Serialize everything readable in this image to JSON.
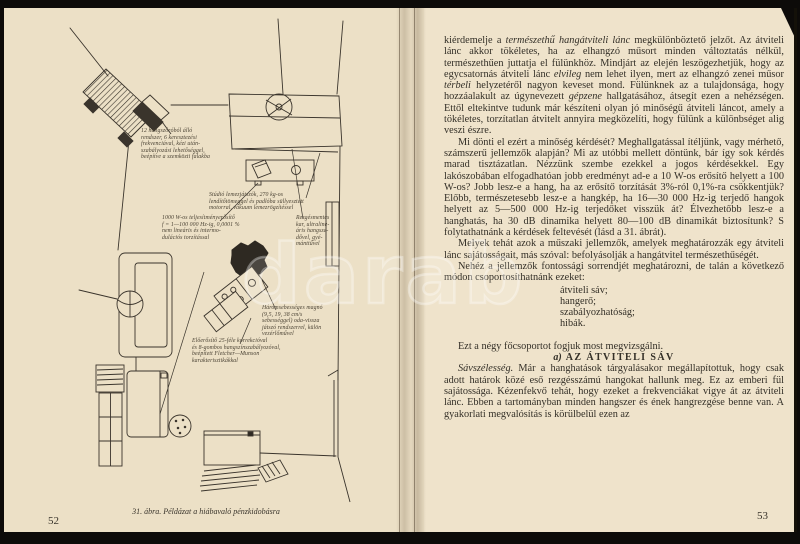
{
  "left_page": {
    "page_number": "52",
    "caption": "31. ábra. Példázat a hiábavaló pénzkidobásra",
    "labels": {
      "speaker": "12 hangszóróból álló\nrendszer, 6 keresztezési\nfrekvenciával, kézi után-\nszabályozási lehetőséggel,\nbeépítve a szemközti falakba",
      "turntable": "Stúdió lemezjátszók, 270 kg-os\nlendítőtömeggel és padlóba süllyesztett\nmotorral, vákuum lemezrögzítéssel",
      "amplifier": "1000 W-os teljesítményerősítő\nf = 1—100 000 Hz-ig, 0,0001 %\nnem lineáris és intermo-\ndulációs torzítással",
      "tonearm": "Rezgésmentes\nkar, ultraline-\náris hangsze-\ndővel, gyé-\nmánttűvel",
      "tape": "Háromsebességes magnó\n(9,5, 19, 38 cm/s\nsebességgel) oda-vissza\njátszó rendszerrel, külön\nvezérlőművel",
      "preamp": "Előerősítő 25-féle korrekcióval\nés 8-gombos hangszínszabályozóval,\nbeépített Fletcher—Munson\nkarakterisztikákkal"
    }
  },
  "right_page": {
    "page_number": "53",
    "paragraphs": {
      "p1": [
        {
          "t": "kiérdemelje a "
        },
        {
          "t": "természethű hangátviteli lánc",
          "i": true
        },
        {
          "t": " megkülönböztető jelzőt. Az átviteli lánc akkor tökéletes, ha az elhangzó műsort minden változtatás nélkül, természethűen juttatja el fülünkhöz. Mindjárt az elején leszögezhetjük, hogy az egycsatornás átviteli lánc "
        },
        {
          "t": "elvileg",
          "i": true
        },
        {
          "t": " nem lehet ilyen, mert az elhangzó zenei műsor "
        },
        {
          "t": "térbeli",
          "i": true
        },
        {
          "t": " helyzetéről nagyon keveset mond. Fülünknek az a tulajdonsága, hogy hozzáalakult az úgynevezett "
        },
        {
          "t": "gépzene",
          "i": true
        },
        {
          "t": " hallgatásához, átsegít ezen a nehézségen. Ettől eltekintve tudunk már készíteni olyan jó minőségű átviteli láncot, amely a tökéletes, torzítatlan átvitelt annyira megközelíti, hogy fülünk a különbséget alig veszi észre."
        }
      ],
      "p2": [
        {
          "t": "Mi dönti el ezért a minőség kérdését? Meghallgatással ítéljünk, vagy mérhető, számszerű jellemzők alapján? Mi az utóbbi mellett döntünk, bár így sok kérdés marad tisztázatlan. Nézzünk szembe ezekkel a jogos kérdésekkel. Egy lakószobában elfogadhatóan jobb eredményt ad-e a 10 W-os erősítő helyett a 100 W-os? Jobb lesz-e a hang, ha az erősítő torzítását 3%-ról 0,1%-ra csökkentjük? Előbb, természetesebb lesz-e a hangkép, ha 16—30 000 Hz-ig terjedő hangok helyett az 5—500 000 Hz-ig terjedőket visszük át? Élvezhetőbb lesz-e a hanghatás, ha 30 dB dinamika helyett 80—100 dB dinamikát biztosítunk? S folytathatnánk a kérdések feltevését (lásd a 31. ábrát)."
        }
      ],
      "p3": [
        {
          "t": "Melyek tehát azok a műszaki jellemzők, amelyek meghatározzák egy átviteli lánc sajátosságait, más szóval: befolyásolják a hangátvitel természethűségét."
        }
      ],
      "p4": [
        {
          "t": "Nehéz a jellemzők fontossági sorrendjét meghatározni, de talán a következő módon csoportosíthatnánk ezeket:"
        }
      ],
      "p5": [
        {
          "t": "Ezt a négy főcsoportot fogjuk most megvizsgálni."
        }
      ],
      "p6": [
        {
          "t": "Sávszélesség.",
          "i": true
        },
        {
          "t": " Már a hanghatások tárgyalásakor megállapítottuk, hogy csak adott határok közé eső rezgésszámú hangokat hallunk meg. Ez az emberi fül sajátossága. Kézenfekvő tehát, hogy ezeket a frekvenciákat vigye át az átviteli lánc. Ebben a tartományban minden hangszer és ének hangrezgése benne van. A gyakorlati megvalósítás is körülbelül ezen az"
        }
      ]
    },
    "list_items": [
      "átviteli sáv;",
      "hangerő;",
      "szabályozhatóság;",
      "hibák."
    ],
    "heading": {
      "prefix": "a)",
      "label": "AZ ÁTVITELI SÁV"
    }
  },
  "watermark": "darab"
}
